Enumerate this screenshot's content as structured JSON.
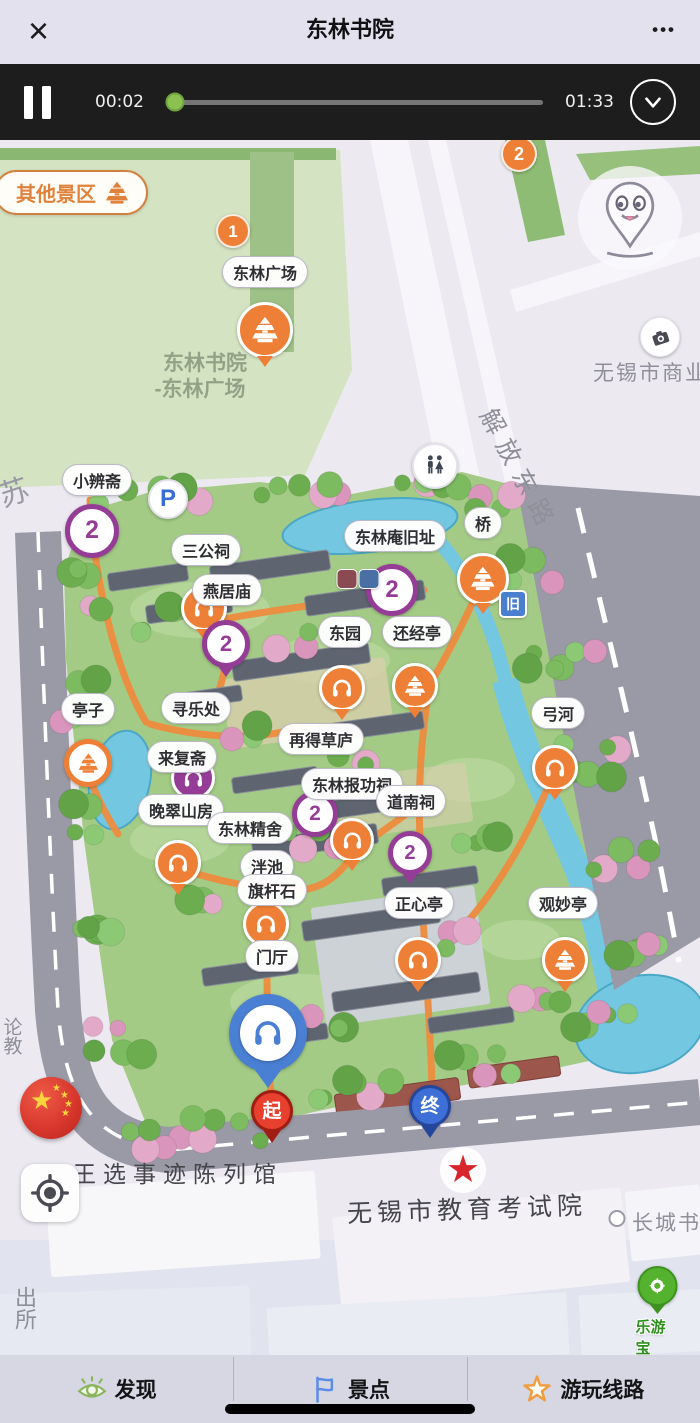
{
  "app": {
    "title": "东林书院",
    "close_glyph": "×",
    "menu_glyph": "•••"
  },
  "player": {
    "current_time": "00:02",
    "total_time": "01:33",
    "progress_percent": 2.5,
    "state": "playing"
  },
  "map": {
    "badge": {
      "label": "其他景区",
      "icon": "pagoda-icon"
    },
    "poi_pills": [
      {
        "label": "东林广场",
        "x": 265,
        "y": 132
      },
      {
        "label": "小辨斋",
        "x": 97,
        "y": 340
      },
      {
        "label": "三公祠",
        "x": 206,
        "y": 410
      },
      {
        "label": "燕居庙",
        "x": 227,
        "y": 450
      },
      {
        "label": "东林庵旧址",
        "x": 395,
        "y": 396
      },
      {
        "label": "桥",
        "x": 483,
        "y": 383
      },
      {
        "label": "东园",
        "x": 345,
        "y": 492
      },
      {
        "label": "还经亭",
        "x": 417,
        "y": 492
      },
      {
        "label": "亭子",
        "x": 88,
        "y": 569
      },
      {
        "label": "寻乐处",
        "x": 196,
        "y": 568
      },
      {
        "label": "来复斋",
        "x": 182,
        "y": 617
      },
      {
        "label": "再得草庐",
        "x": 321,
        "y": 599
      },
      {
        "label": "晚翠山房",
        "x": 181,
        "y": 670
      },
      {
        "label": "东林报功祠",
        "x": 352,
        "y": 644
      },
      {
        "label": "东林精舍",
        "x": 250,
        "y": 688
      },
      {
        "label": "道南祠",
        "x": 411,
        "y": 661
      },
      {
        "label": "泮池",
        "x": 267,
        "y": 726
      },
      {
        "label": "旗杆石",
        "x": 272,
        "y": 750
      },
      {
        "label": "正心亭",
        "x": 419,
        "y": 763
      },
      {
        "label": "弓河",
        "x": 558,
        "y": 573
      },
      {
        "label": "观妙亭",
        "x": 563,
        "y": 763
      },
      {
        "label": "门厅",
        "x": 272,
        "y": 816
      }
    ],
    "region_labels": [
      {
        "text": "东林书院",
        "x": 205,
        "y": 222,
        "size": 21,
        "color": "#93a186",
        "weight": 600
      },
      {
        "text": "-东林广场",
        "x": 200,
        "y": 248,
        "size": 21,
        "color": "#93a186",
        "weight": 600
      },
      {
        "text": "解放东路",
        "x": 520,
        "y": 330,
        "size": 25,
        "color": "#8f8f9a",
        "rotate": 62,
        "spacing": 9
      },
      {
        "text": "无锡市商业纪",
        "x": 662,
        "y": 232,
        "size": 21,
        "color": "#8f8f9a",
        "spacing": 2
      },
      {
        "text": "王选事迹陈列馆",
        "x": 178,
        "y": 1032,
        "size": 23,
        "color": "#45454c",
        "spacing": 7
      },
      {
        "text": "无锡市教育考试院",
        "x": 467,
        "y": 1068,
        "size": 25,
        "color": "#45454c",
        "spacing": 5,
        "rotate": -2
      },
      {
        "text": "长城书画",
        "x": 678,
        "y": 1082,
        "size": 21,
        "color": "#8f8f9a",
        "spacing": 2
      },
      {
        "text": "出所",
        "x": 24,
        "y": 1168,
        "size": 22,
        "color": "#8f8f9a",
        "vertical": true
      },
      {
        "text": "论教",
        "x": 11,
        "y": 896,
        "size": 19,
        "color": "#8f8f9a",
        "vertical": true
      },
      {
        "text": "苏",
        "x": 13,
        "y": 350,
        "size": 30,
        "color": "#9a9aa5",
        "rotate": -18
      }
    ],
    "markers": [
      {
        "type": "face-pin",
        "x": 630,
        "y": 78
      },
      {
        "type": "camera",
        "x": 660,
        "y": 198
      },
      {
        "type": "num-orange",
        "n": "1",
        "x": 233,
        "y": 93,
        "size": 34
      },
      {
        "type": "num-orange",
        "n": "2",
        "x": 519,
        "y": 16,
        "size": 36
      },
      {
        "type": "orange-pin",
        "glyph": "pagoda",
        "x": 265,
        "y": 192,
        "size": 56,
        "tail": true
      },
      {
        "type": "parking",
        "x": 168,
        "y": 360
      },
      {
        "type": "restroom",
        "x": 435,
        "y": 327
      },
      {
        "type": "purple-num",
        "n": "2",
        "x": 92,
        "y": 393,
        "size": 54
      },
      {
        "type": "orange-pin",
        "glyph": "headphone",
        "x": 204,
        "y": 470,
        "size": 46,
        "tail": true
      },
      {
        "type": "purple-num",
        "n": "2",
        "x": 226,
        "y": 506,
        "size": 48,
        "tail": true
      },
      {
        "type": "orange-pin",
        "glyph": "pagoda",
        "x": 483,
        "y": 441,
        "size": 52,
        "tail": true
      },
      {
        "type": "purple-num",
        "n": "2",
        "x": 392,
        "y": 452,
        "size": 52
      },
      {
        "type": "icon-old",
        "ch": "旧",
        "x": 513,
        "y": 463
      },
      {
        "type": "mini-roof",
        "color": "#8a4a52",
        "x": 347,
        "y": 439
      },
      {
        "type": "mini-roof",
        "color": "#4a6fa5",
        "x": 369,
        "y": 439
      },
      {
        "type": "orange-pin",
        "glyph": "pagoda",
        "x": 88,
        "y": 625,
        "size": 48,
        "inverse": true
      },
      {
        "type": "orange-pin",
        "glyph": "headphone",
        "x": 342,
        "y": 550,
        "size": 46,
        "tail": true
      },
      {
        "type": "orange-pin",
        "glyph": "pagoda",
        "x": 415,
        "y": 548,
        "size": 46,
        "tail": true
      },
      {
        "type": "purple-pin",
        "glyph": "headphone",
        "x": 193,
        "y": 640,
        "size": 44,
        "tail": true
      },
      {
        "type": "purple-num",
        "n": "2",
        "x": 315,
        "y": 676,
        "size": 46
      },
      {
        "type": "orange-pin",
        "glyph": "headphone",
        "x": 178,
        "y": 725,
        "size": 46,
        "tail": true
      },
      {
        "type": "orange-pin",
        "glyph": "headphone",
        "x": 352,
        "y": 702,
        "size": 44,
        "tail": true
      },
      {
        "type": "orange-pin",
        "glyph": "headphone",
        "x": 266,
        "y": 786,
        "size": 46,
        "tail": true
      },
      {
        "type": "purple-num",
        "n": "2",
        "x": 410,
        "y": 715,
        "size": 44,
        "tail": true
      },
      {
        "type": "orange-pin",
        "glyph": "headphone",
        "x": 555,
        "y": 630,
        "size": 46,
        "tail": true
      },
      {
        "type": "orange-pin",
        "glyph": "headphone",
        "x": 418,
        "y": 822,
        "size": 46,
        "tail": true
      },
      {
        "type": "orange-pin",
        "glyph": "pagoda",
        "x": 565,
        "y": 822,
        "size": 46,
        "tail": true
      },
      {
        "type": "blue-headphone",
        "x": 268,
        "y": 893,
        "size": 78
      },
      {
        "type": "start-pin",
        "ch": "起",
        "x": 272,
        "y": 973,
        "size": 42
      },
      {
        "type": "end-pin",
        "ch": "终",
        "x": 430,
        "y": 968,
        "size": 42
      },
      {
        "type": "flag-ball",
        "x": 51,
        "y": 968
      },
      {
        "type": "red-star",
        "x": 463,
        "y": 1030
      },
      {
        "type": "poi-dot",
        "x": 617,
        "y": 1078
      },
      {
        "type": "leyoubao",
        "label": "乐游宝",
        "x": 657,
        "y": 1147
      },
      {
        "type": "locate",
        "x": 50,
        "y": 1053
      }
    ]
  },
  "nav": {
    "items": [
      {
        "id": "discover",
        "label": "发现",
        "icon": "eye-icon"
      },
      {
        "id": "spots",
        "label": "景点",
        "icon": "flag-icon"
      },
      {
        "id": "routes",
        "label": "游玩线路",
        "icon": "star-icon"
      }
    ]
  },
  "theme": {
    "accent_orange": "#ee7f36",
    "accent_purple": "#953d96",
    "accent_blue": "#4a80d4",
    "park_green": "#a3cb85",
    "road_gray": "#9a99a6",
    "player_bg": "#1d1d1d",
    "topbar_bg": "#e3e1ed",
    "nav_bg": "#d7d7e4"
  }
}
